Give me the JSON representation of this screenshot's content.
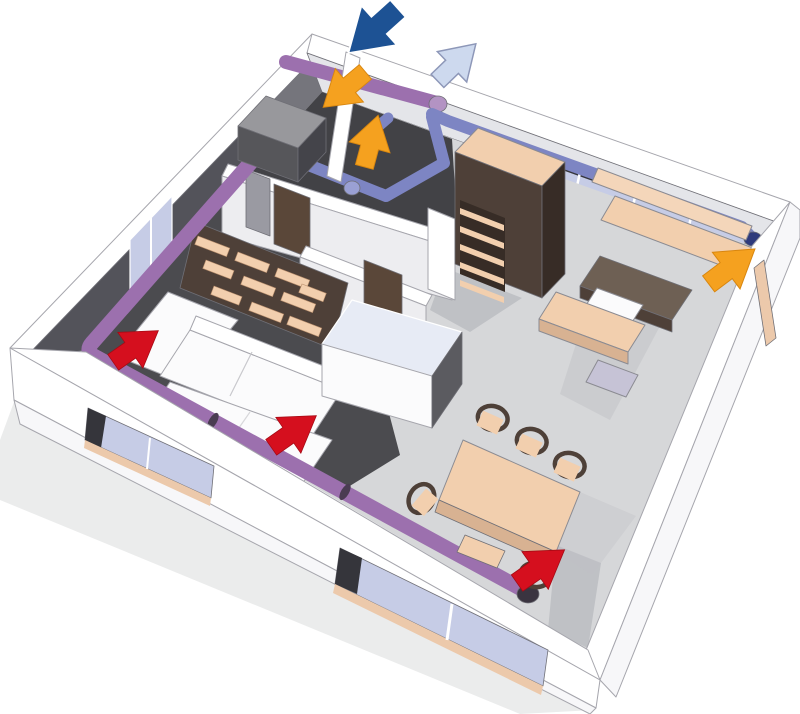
{
  "scene": {
    "background": "#ffffff",
    "colors": {
      "wall_white": "#ffffff",
      "wall_face": "#f7f7f9",
      "wall_inner": "#e4e5e9",
      "wall_band_shade": "#ededf0",
      "wall_anthracite": "#53535a",
      "rooms_wall_gray": "#75757c",
      "floor_light": "#d6d7d9",
      "floor_dark": "#4b4b4f",
      "rooms_floor_dark": "#424246",
      "floor_shadow": "#bfc1c5",
      "ground_shadow": "#ebecec",
      "glass": "#c6cce6",
      "glass_streak": "#e6eaf6",
      "glass_frame_dark": "#35353b",
      "sill_peach": "#ecc9ab",
      "peach": "#f2cfae",
      "peach_dark": "#d8b292",
      "peach_light": "#f4d6ba",
      "wood_dark": "#4e4038",
      "wood_darker": "#372c26",
      "wood_mid": "#6e6054",
      "door_brown": "#5a4739",
      "panel_gray": "#9a9aa2",
      "white_furniture": "#fbfbfc",
      "case_glass_top": "#e7ebf5",
      "case_side": "#5b5b60",
      "bench_lavender": "#c6c3d6",
      "duct_purple": "#9c70ae",
      "duct_purple_cap": "#b393c3",
      "duct_sleeve": "#4a3c52",
      "duct_end_dark": "#3a3440",
      "duct_blue": "#7d85c3",
      "duct_blue_dark": "#2e3a7c",
      "duct_blue_light": "#9aa0d4",
      "unit_top": "#98989c",
      "unit_front": "#56565a",
      "unit_side": "#44444a",
      "arrow_red": "#d50f1e",
      "arrow_red_edge": "#a50a14",
      "arrow_orange": "#f5a11f",
      "arrow_orange_edge": "#d8860f",
      "arrow_dark_blue": "#1d5294",
      "arrow_dark_blue_edge": "#ffffff",
      "arrow_light_blue": "#cdd9ee",
      "arrow_light_blue_edge": "#8d97b8"
    },
    "ducts": [
      {
        "name": "extract-duct-purple",
        "color": "#9c70ae"
      },
      {
        "name": "supply-duct-blue",
        "color": "#7d85c3"
      }
    ],
    "arrows": [
      {
        "name": "outdoor-air-intake-arrow",
        "color": "#1d5294"
      },
      {
        "name": "exhaust-air-outlet-arrow",
        "color": "#cdd9ee"
      },
      {
        "name": "airflow-arrow-utility-room",
        "color": "#f5a11f"
      },
      {
        "name": "airflow-arrow-bathroom",
        "color": "#f5a11f"
      },
      {
        "name": "airflow-arrow-kitchen",
        "color": "#f5a11f"
      },
      {
        "name": "airflow-arrow-living-room",
        "color": "#d50f1e"
      },
      {
        "name": "airflow-arrow-bedroom-rug",
        "color": "#d50f1e"
      },
      {
        "name": "airflow-arrow-dining-area",
        "color": "#d50f1e"
      }
    ],
    "rooms": [
      "utility-room",
      "bathroom",
      "living-room",
      "hallway",
      "kitchen",
      "dining-area"
    ],
    "furniture": [
      "heat-recovery-unit",
      "corner-sofa",
      "wall-shelving",
      "rug",
      "display-case",
      "wardrobe",
      "kitchen-counters",
      "kitchen-island",
      "dining-table",
      "chairs",
      "bench"
    ]
  }
}
